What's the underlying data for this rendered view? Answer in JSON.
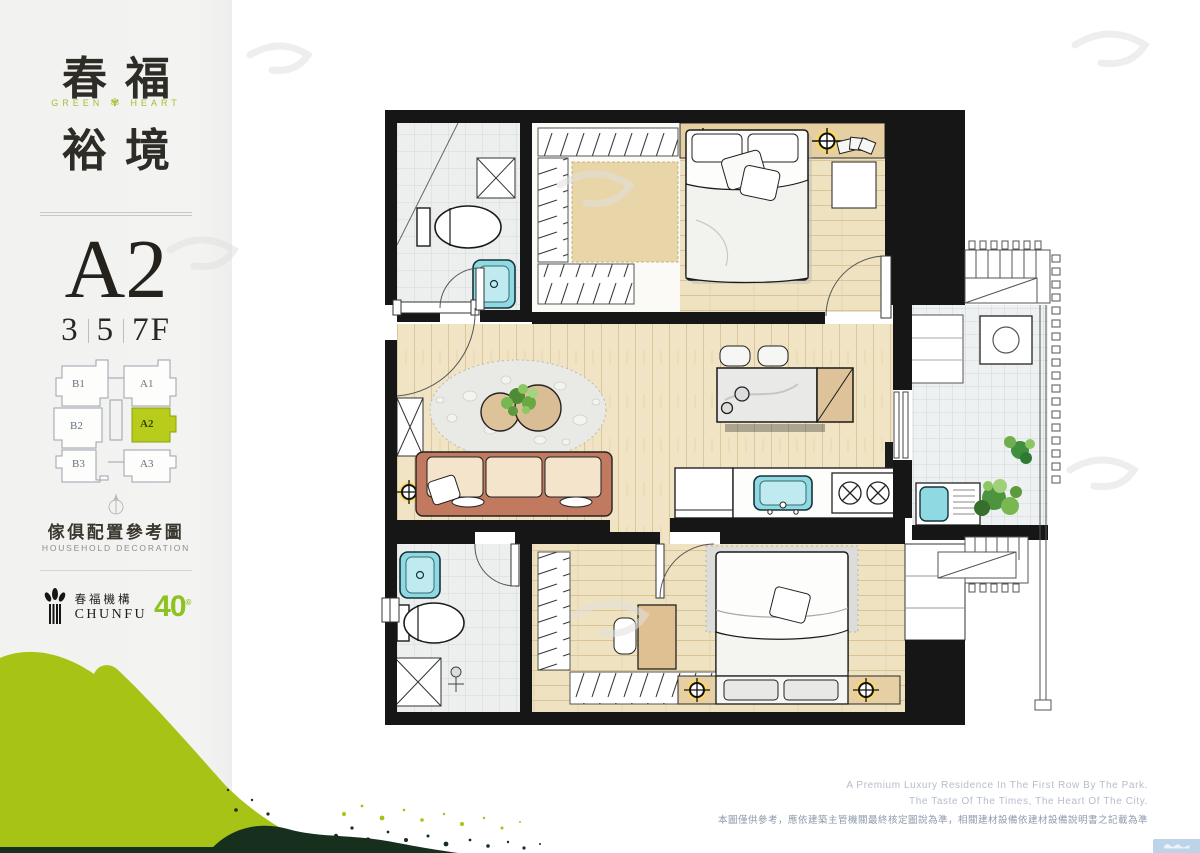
{
  "sidebar": {
    "title_top": "春福",
    "title_bottom": "裕境",
    "subtitle_left": "GREEN",
    "subtitle_right": "HEART",
    "unit": "A2",
    "floors": [
      "3",
      "5",
      "7F"
    ],
    "keyplan": {
      "left_units": [
        "B1",
        "B2",
        "B3"
      ],
      "right_units": [
        "A1",
        "A2",
        "A3"
      ],
      "highlighted": "A2",
      "highlight_color": "#b8cc1c"
    },
    "caption_zh": "傢俱配置參考圖",
    "caption_en": "HOUSEHOLD DECORATION",
    "brand": {
      "name_zh": "春福機構",
      "name_en": "CHUNFU",
      "anniversary": "40",
      "accent": "#8dc21f"
    }
  },
  "footer": {
    "tagline_line1": "A Premium Luxury Residence In The First Row By The Park.",
    "tagline_line2": "The Taste Of The Times, The Heart Of The City.",
    "disclaimer": "本圖僅供參考，應依建築主管機關最終核定圖說為準，相關建材設備依建材設備說明書之記載為準"
  },
  "colors": {
    "splash_light": "#a6c316",
    "splash_dark": "#16301d",
    "wall": "#161616",
    "wood_floor": "#f0e4c5",
    "tile_floor": "#edefef",
    "fixture_blue": "#8ed9e2",
    "sofa_frame": "#c1795f",
    "lamp_yellow": "#ffd94f",
    "headboard_tan": "#e7cfa4"
  }
}
